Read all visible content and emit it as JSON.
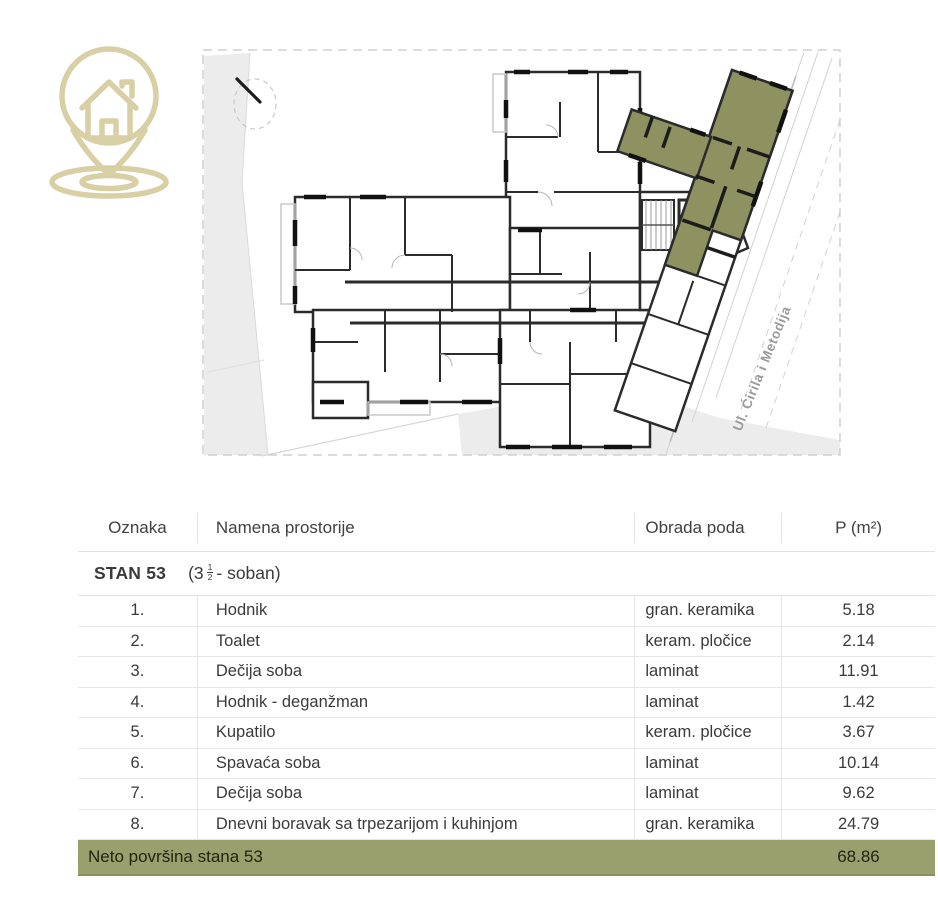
{
  "logo": {
    "name": "house location pin",
    "color": "#d8cfa4"
  },
  "plan": {
    "street_label": "Ul. Ćirila i Metodija",
    "highlight_color": "#8d9260",
    "north_indicator": "compass needle"
  },
  "table": {
    "headers": {
      "oznaka": "Oznaka",
      "namena": "Namena prostorije",
      "obrada": "Obrada poda",
      "p": "P (m²)"
    },
    "unit": {
      "name": "STAN 53",
      "pre": "(3",
      "frac_num": "1",
      "frac_den": "2",
      "post": "- soban)"
    },
    "rows": [
      {
        "num": "1.",
        "name": "Hodnik",
        "floor": "gran. keramika",
        "area": "5.18"
      },
      {
        "num": "2.",
        "name": "Toalet",
        "floor": "keram. pločice",
        "area": "2.14"
      },
      {
        "num": "3.",
        "name": "Dečija soba",
        "floor": "laminat",
        "area": "11.91"
      },
      {
        "num": "4.",
        "name": "Hodnik - deganžman",
        "floor": "laminat",
        "area": "1.42"
      },
      {
        "num": "5.",
        "name": "Kupatilo",
        "floor": "keram. pločice",
        "area": "3.67"
      },
      {
        "num": "6.",
        "name": "Spavaća soba",
        "floor": "laminat",
        "area": "10.14"
      },
      {
        "num": "7.",
        "name": "Dečija soba",
        "floor": "laminat",
        "area": "9.62"
      },
      {
        "num": "8.",
        "name": "Dnevni boravak sa trpezarijom i kuhinjom",
        "floor": "gran. keramika",
        "area": "24.79"
      }
    ],
    "footer": {
      "label": "Neto površina stana 53",
      "value": "68.86"
    }
  },
  "colors": {
    "accent_olive": "#99a06e",
    "apartment_green": "#8d9260",
    "logo_gold": "#d8cfa4"
  }
}
